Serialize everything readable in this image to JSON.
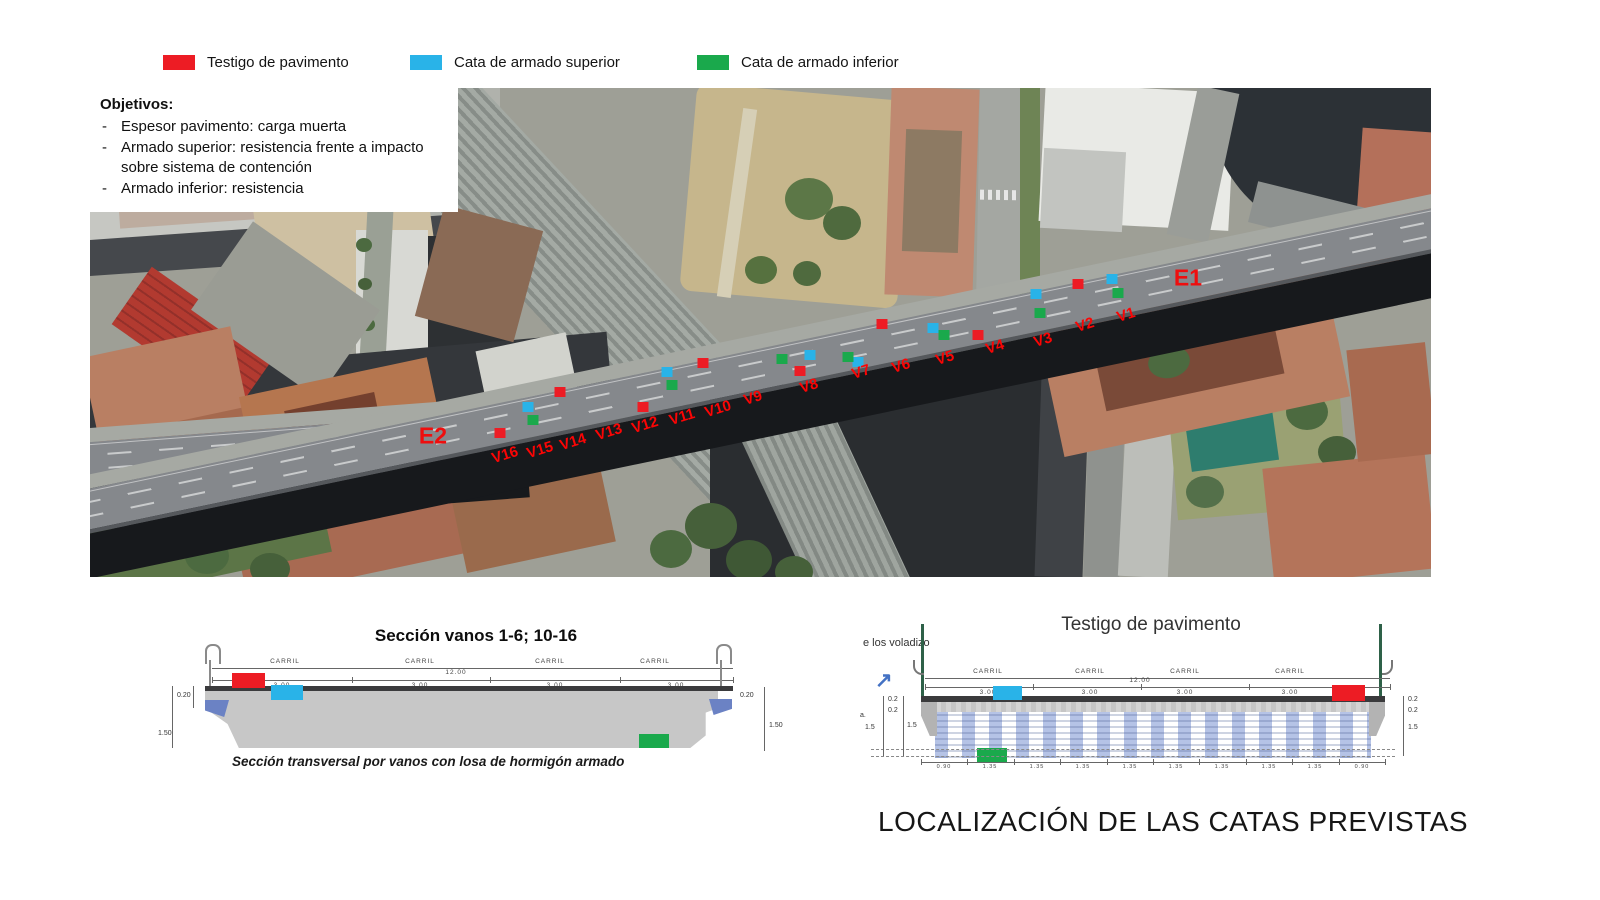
{
  "legend": {
    "items": [
      {
        "id": "pavimento",
        "label": "Testigo de pavimento",
        "color": "#ed1c24"
      },
      {
        "id": "armado-superior",
        "label": "Cata de armado superior",
        "color": "#29b3e8"
      },
      {
        "id": "armado-inferior",
        "label": "Cata de armado inferior",
        "color": "#1aa94c"
      }
    ]
  },
  "objectives": {
    "title": "Objetivos:",
    "items": [
      "Espesor pavimento: carga muerta",
      "Armado superior: resistencia frente a impacto sobre sistema de contención",
      "Armado inferior: resistencia"
    ]
  },
  "map": {
    "stations": [
      {
        "label": "E1",
        "x": 1098,
        "y": 190
      },
      {
        "label": "E2",
        "x": 343,
        "y": 348
      }
    ],
    "v_labels": [
      {
        "label": "V1",
        "x": 1036,
        "y": 227
      },
      {
        "label": "V2",
        "x": 995,
        "y": 237
      },
      {
        "label": "V3",
        "x": 953,
        "y": 252
      },
      {
        "label": "V4",
        "x": 905,
        "y": 259
      },
      {
        "label": "V5",
        "x": 855,
        "y": 270
      },
      {
        "label": "V6",
        "x": 811,
        "y": 278
      },
      {
        "label": "V7",
        "x": 771,
        "y": 284
      },
      {
        "label": "V8",
        "x": 719,
        "y": 298
      },
      {
        "label": "V9",
        "x": 663,
        "y": 310
      },
      {
        "label": "V10",
        "x": 628,
        "y": 321
      },
      {
        "label": "V11",
        "x": 592,
        "y": 329
      },
      {
        "label": "V12",
        "x": 555,
        "y": 337
      },
      {
        "label": "V13",
        "x": 519,
        "y": 344
      },
      {
        "label": "V14",
        "x": 483,
        "y": 354
      },
      {
        "label": "V15",
        "x": 450,
        "y": 362
      },
      {
        "label": "V16",
        "x": 415,
        "y": 367
      }
    ],
    "markers": [
      {
        "kind": "pavimento",
        "x": 988,
        "y": 196
      },
      {
        "kind": "pavimento",
        "x": 888,
        "y": 247
      },
      {
        "kind": "pavimento",
        "x": 792,
        "y": 236
      },
      {
        "kind": "pavimento",
        "x": 710,
        "y": 283
      },
      {
        "kind": "pavimento",
        "x": 613,
        "y": 275
      },
      {
        "kind": "pavimento",
        "x": 553,
        "y": 319
      },
      {
        "kind": "pavimento",
        "x": 470,
        "y": 304
      },
      {
        "kind": "pavimento",
        "x": 410,
        "y": 345
      },
      {
        "kind": "armado-superior",
        "x": 1022,
        "y": 191
      },
      {
        "kind": "armado-superior",
        "x": 946,
        "y": 206
      },
      {
        "kind": "armado-superior",
        "x": 843,
        "y": 240
      },
      {
        "kind": "armado-superior",
        "x": 768,
        "y": 274
      },
      {
        "kind": "armado-superior",
        "x": 720,
        "y": 267
      },
      {
        "kind": "armado-superior",
        "x": 577,
        "y": 284
      },
      {
        "kind": "armado-superior",
        "x": 438,
        "y": 319
      },
      {
        "kind": "armado-inferior",
        "x": 1028,
        "y": 205
      },
      {
        "kind": "armado-inferior",
        "x": 950,
        "y": 225
      },
      {
        "kind": "armado-inferior",
        "x": 854,
        "y": 247
      },
      {
        "kind": "armado-inferior",
        "x": 758,
        "y": 269
      },
      {
        "kind": "armado-inferior",
        "x": 692,
        "y": 271
      },
      {
        "kind": "armado-inferior",
        "x": 582,
        "y": 297
      },
      {
        "kind": "armado-inferior",
        "x": 443,
        "y": 332
      }
    ]
  },
  "section_left": {
    "title": "Sección vanos 1-6; 10-16",
    "caption": "Sección transversal por vanos con losa de hormigón armado",
    "carril_label": "CARRIL",
    "total_width": "12.00",
    "lane_width": "3.00",
    "dim_left": [
      "0.20",
      "1.50"
    ],
    "dim_right": [
      "0.20",
      "1.50"
    ]
  },
  "section_right": {
    "title": "Testigo de pavimento",
    "note": "e los voladizo",
    "carril_label": "CARRIL",
    "total_width": "12.00",
    "lane_width": "3.00",
    "dims_left": [
      "0.2",
      "0.2",
      "a.",
      "1.5",
      "1.5"
    ],
    "dims_right": [
      "0.2",
      "0.2",
      "1.5"
    ],
    "bottom_dims": [
      "0.90",
      "1.35",
      "1.35",
      "1.35",
      "1.35",
      "1.35",
      "1.35",
      "1.35",
      "1.35",
      "0.90"
    ]
  },
  "icons": {
    "north_east_arrow": "↗"
  },
  "footer": {
    "title": "LOCALIZACIÓN DE LAS CATAS PREVISTAS"
  }
}
